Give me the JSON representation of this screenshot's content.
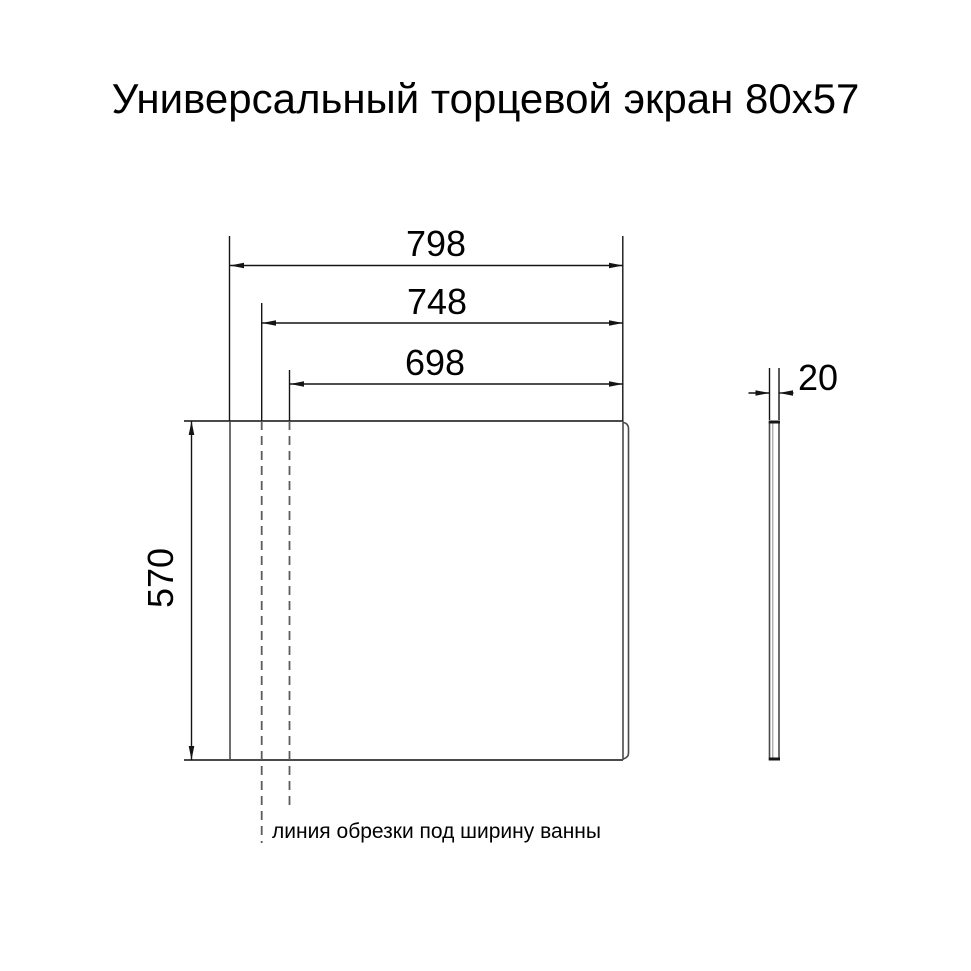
{
  "title": "Универсальный торцевой экран 80х57",
  "front_view": {
    "dim_width_outer": "798",
    "dim_width_middle": "748",
    "dim_width_inner": "698",
    "dim_height": "570"
  },
  "side_view": {
    "dim_thickness": "20"
  },
  "annotation": {
    "cut_line_label": "линия обрезки под ширину ванны"
  },
  "colors": {
    "outline": "#4a4a4a",
    "dimension": "#141414",
    "dashed_cut_line": "#5c5c5c",
    "text": "#000000",
    "background": "#ffffff"
  }
}
